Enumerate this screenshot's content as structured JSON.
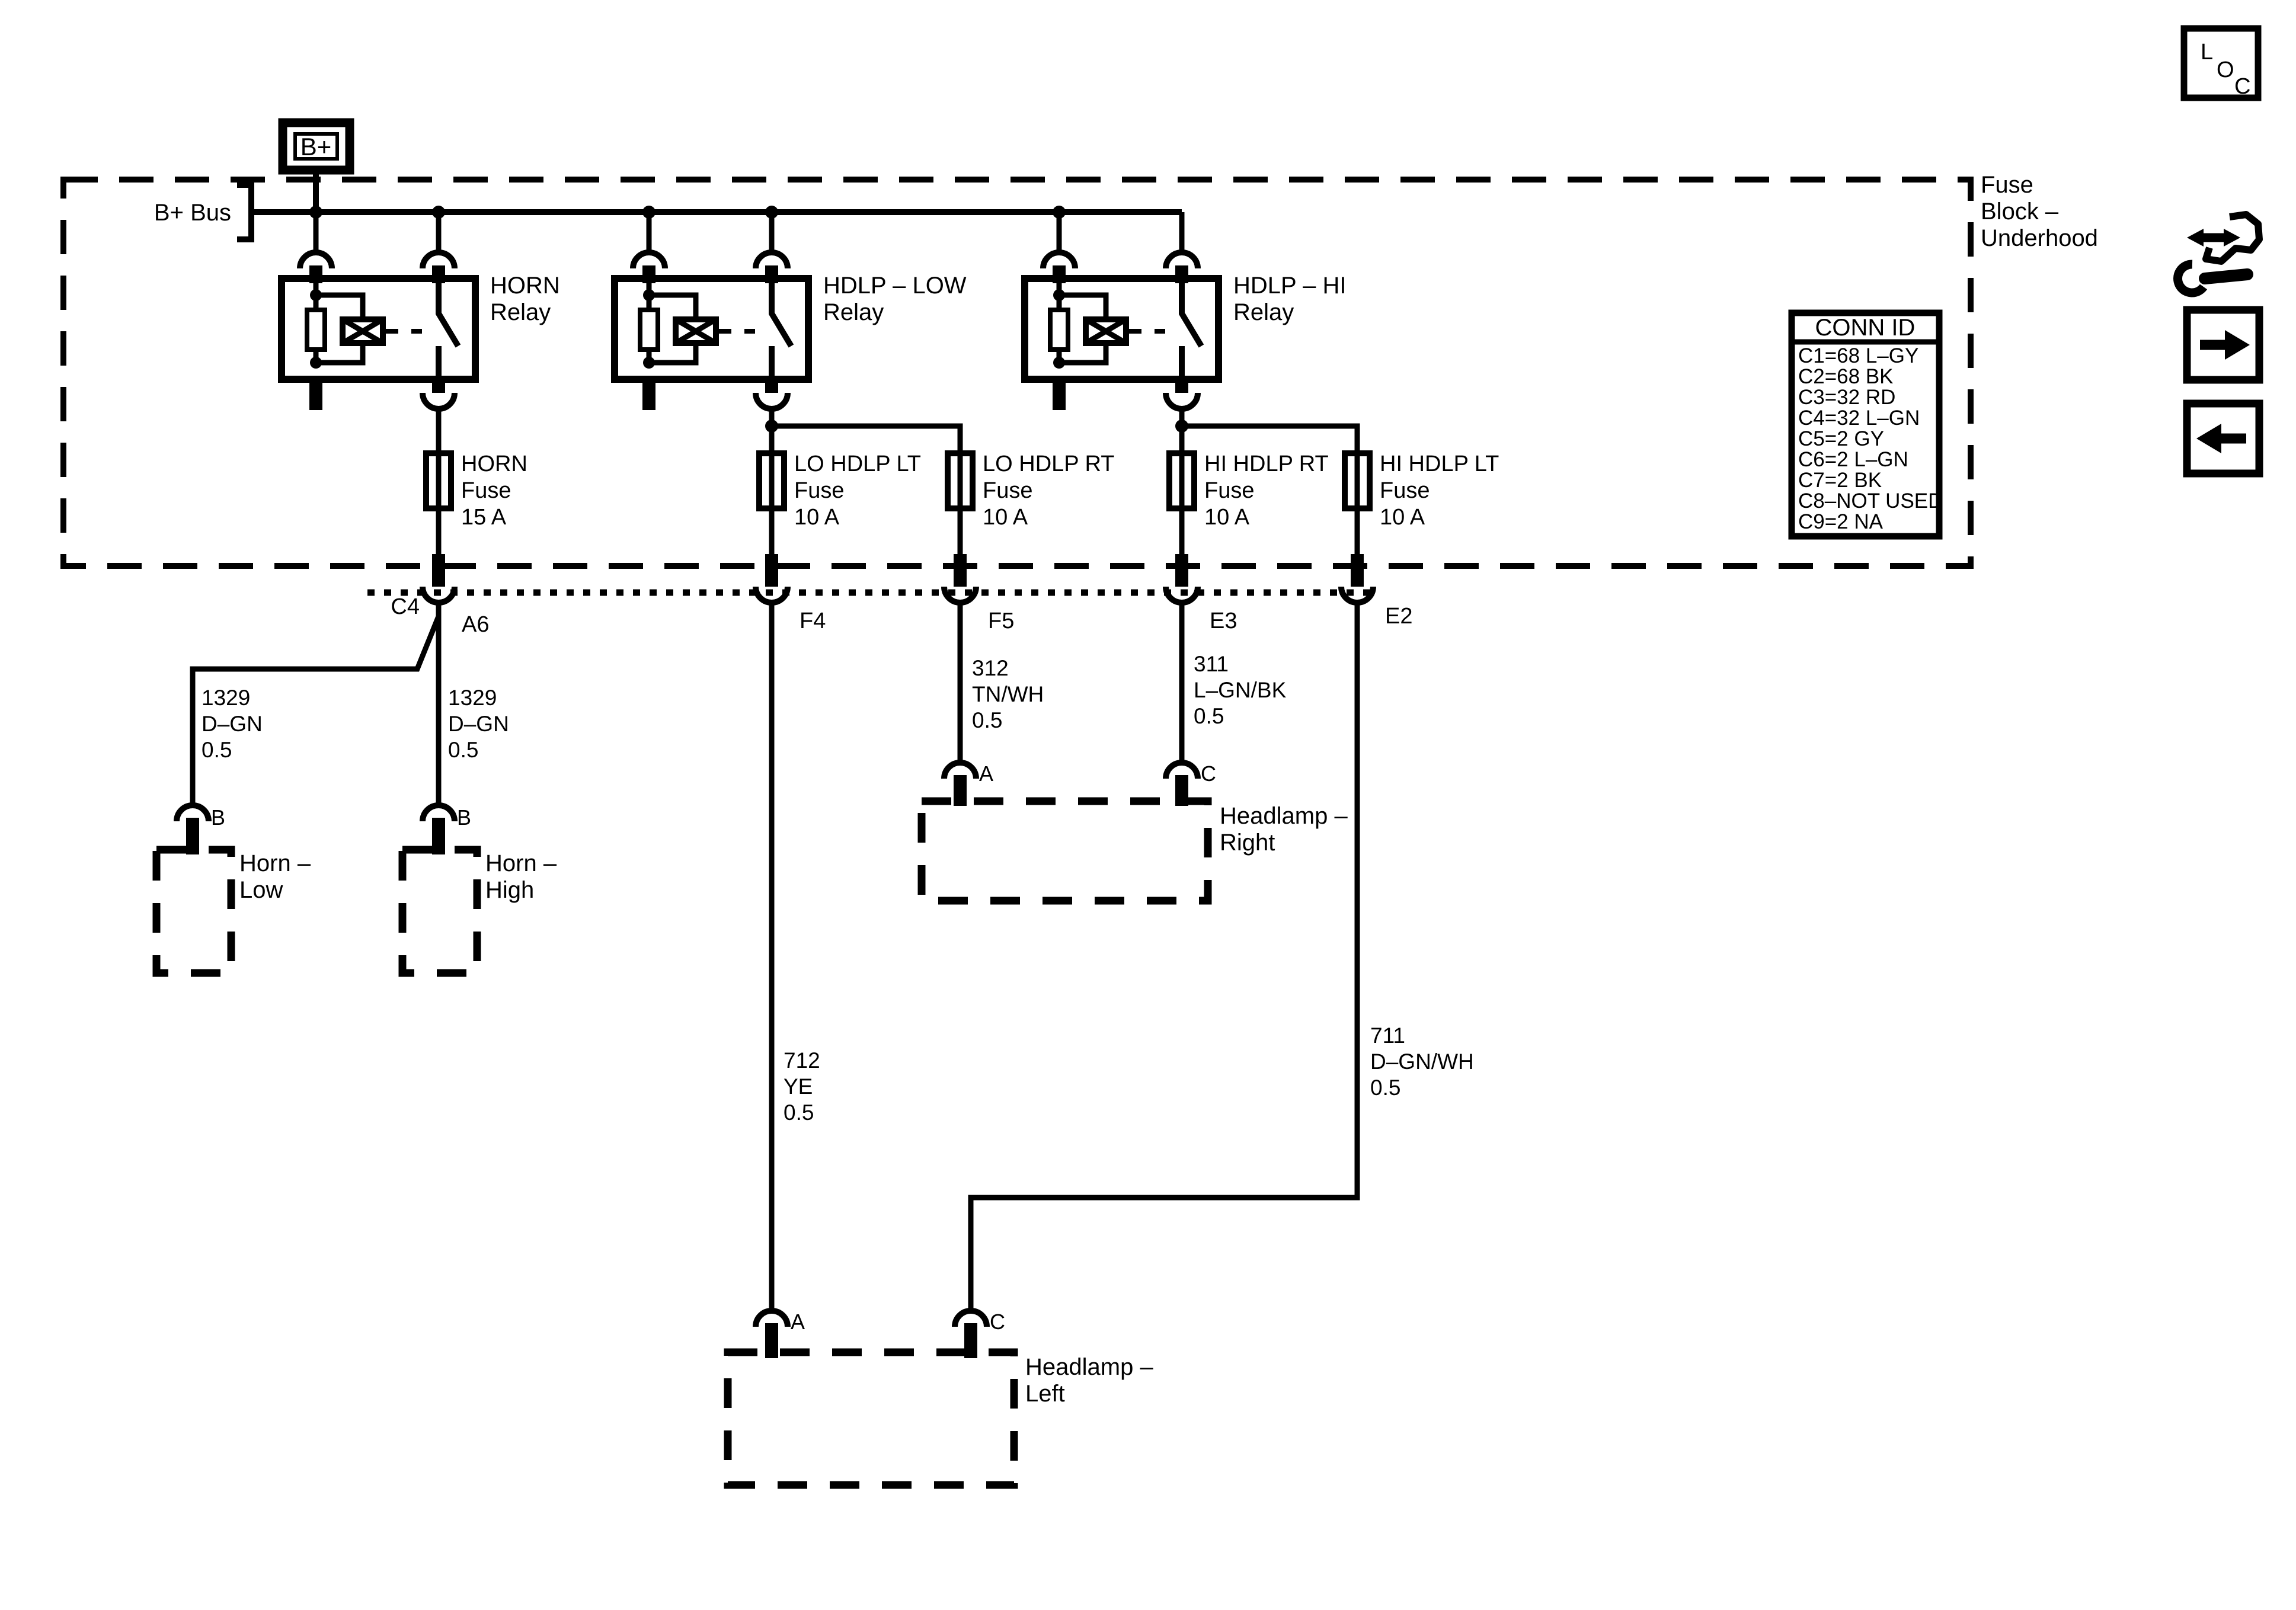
{
  "loc_box": {
    "letters": [
      "L",
      "O",
      "C"
    ]
  },
  "header": {
    "fuse_block_label": [
      "Fuse",
      "Block –",
      "Underhood"
    ]
  },
  "power": {
    "bplus": "B+",
    "bus_label": "B+ Bus"
  },
  "relays": [
    {
      "label": [
        "HORN",
        "Relay"
      ]
    },
    {
      "label": [
        "HDLP – LOW",
        "Relay"
      ]
    },
    {
      "label": [
        "HDLP – HI",
        "Relay"
      ]
    }
  ],
  "fuses": [
    {
      "label": [
        "HORN",
        "Fuse",
        "15 A"
      ]
    },
    {
      "label": [
        "LO HDLP LT",
        "Fuse",
        "10 A"
      ]
    },
    {
      "label": [
        "LO HDLP RT",
        "Fuse",
        "10 A"
      ]
    },
    {
      "label": [
        "HI HDLP RT",
        "Fuse",
        "10 A"
      ]
    },
    {
      "label": [
        "HI HDLP LT",
        "Fuse",
        "10 A"
      ]
    }
  ],
  "conn_table": {
    "title": "CONN ID",
    "rows": [
      "C1=68 L–GY",
      "C2=68 BK",
      "C3=32 RD",
      "C4=32 L–GN",
      "C5=2 GY",
      "C6=2 L–GN",
      "C7=2 BK",
      "C8–NOT USED",
      "C9=2 NA"
    ]
  },
  "connector_pins": {
    "c4": "C4",
    "a6": "A6",
    "f4": "F4",
    "f5": "F5",
    "e3": "E3",
    "e2": "E2"
  },
  "wires": {
    "w1329_left": [
      "1329",
      "D–GN",
      "0.5"
    ],
    "w1329_right": [
      "1329",
      "D–GN",
      "0.5"
    ],
    "w312": [
      "312",
      "TN/WH",
      "0.5"
    ],
    "w311": [
      "311",
      "L–GN/BK",
      "0.5"
    ],
    "w712": [
      "712",
      "YE",
      "0.5"
    ],
    "w711": [
      "711",
      "D–GN/WH",
      "0.5"
    ]
  },
  "components": {
    "horn_low": {
      "label": [
        "Horn –",
        "Low"
      ],
      "pin": "B"
    },
    "horn_high": {
      "label": [
        "Horn –",
        "High"
      ],
      "pin": "B"
    },
    "headlamp_right": {
      "label": [
        "Headlamp –",
        "Right"
      ],
      "pin_a": "A",
      "pin_c": "C"
    },
    "headlamp_left": {
      "label": [
        "Headlamp –",
        "Left"
      ],
      "pin_a": "A",
      "pin_c": "C"
    }
  }
}
